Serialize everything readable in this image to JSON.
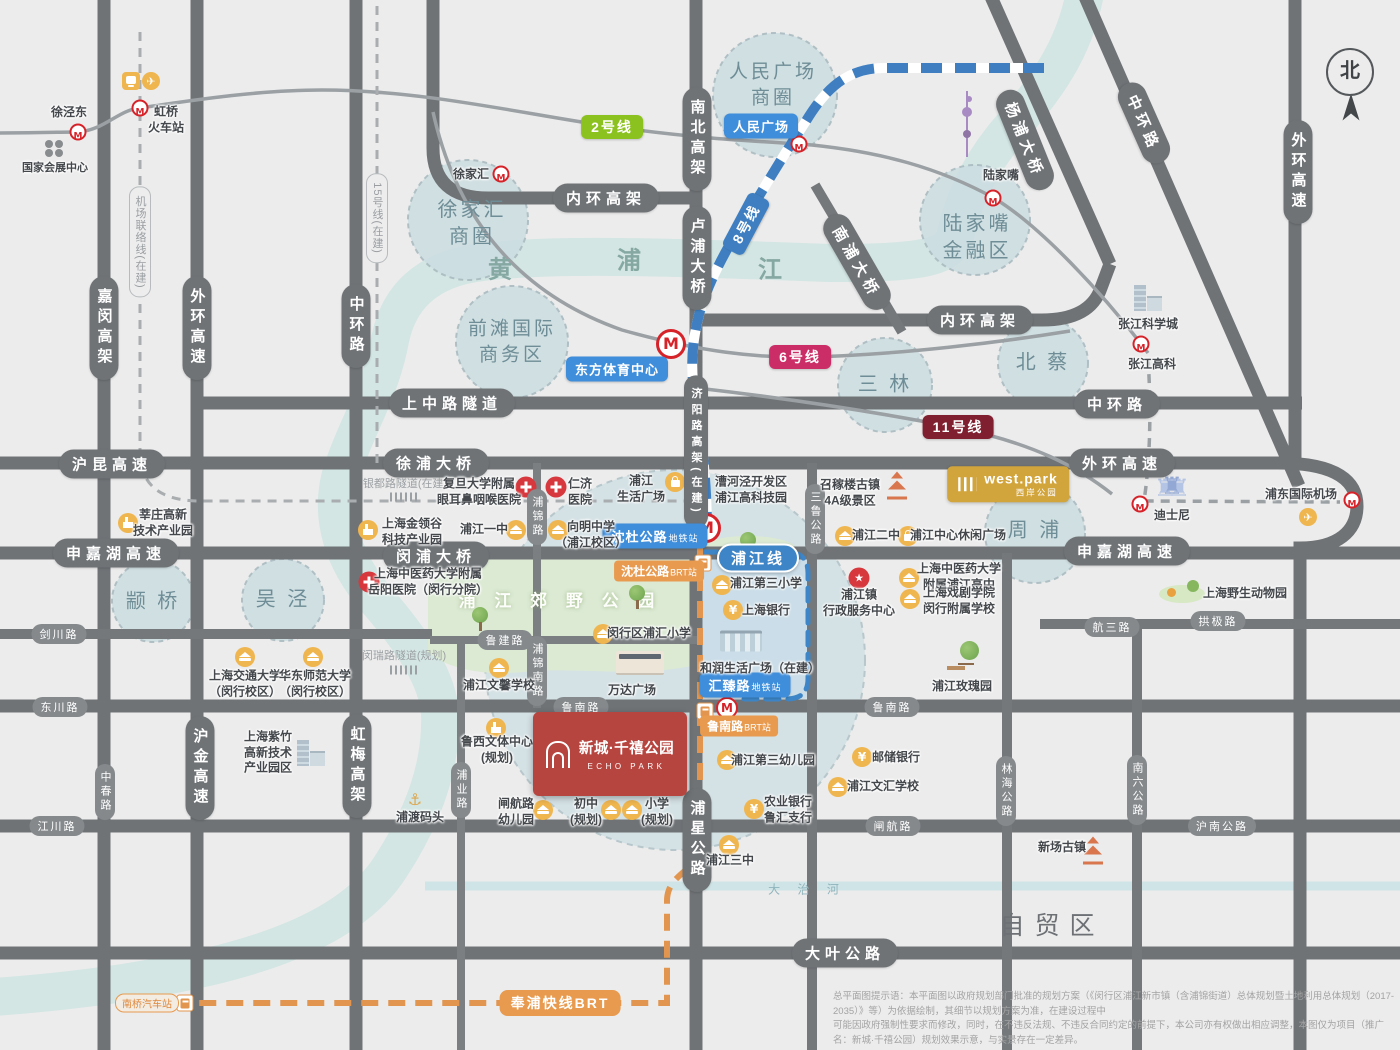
{
  "compass": {
    "label": "北"
  },
  "project": {
    "name_zh": "新城·千禧公园",
    "name_en": "ECHO PARK"
  },
  "west_park": {
    "name_en": "west.park",
    "name_zh": "西岸公园"
  },
  "disclaimer": {
    "line1": "总平面图提示语：本平面图以政府规划部门批准的规划方案（《闵行区浦江新市镇（含浦锦街道）总体规划暨土地利用总体规划（2017-2035）》等）为依据绘制，其细节以规划方案为准，在建设过程中",
    "line2": "可能因政府强制性要求而修改，同时，在不违反法规、不违反合同约定的前提下，本公司亦有权做出相应调整，本图仅为项目（推广名：新城·千禧公园）规划效果示意，与实景存在一定差异。"
  },
  "colors": {
    "road": "#6f7376",
    "river": "#d3e6e3",
    "district": "#cddee2",
    "metro_red": "#d6232a",
    "line2": "#8cc21f",
    "line6": "#cb2e67",
    "line8": "#3f7fc1",
    "line11": "#801f30",
    "brt_orange": "#e89a4f",
    "station_blue": "#3f8edb",
    "project_red": "#b7453f",
    "gold": "#d2a43c"
  },
  "labels": [
    {
      "c": "pill-v",
      "t": "嘉闵高架",
      "x": 104,
      "y": 328
    },
    {
      "c": "pill-v",
      "t": "外环高速",
      "x": 197,
      "y": 328
    },
    {
      "c": "pill-v",
      "t": "中环路",
      "x": 356,
      "y": 326
    },
    {
      "c": "pill-v",
      "t": "南北高架",
      "x": 697,
      "y": 139
    },
    {
      "c": "pill-v",
      "t": "卢浦大桥",
      "x": 697,
      "y": 258
    },
    {
      "c": "pill-v",
      "t": "济阳路高架(在建)",
      "x": 696,
      "y": 452,
      "fs": 11
    },
    {
      "c": "pill-v",
      "t": "外环高速",
      "x": 1298,
      "y": 172
    },
    {
      "c": "pill-v",
      "t": "浦星公路",
      "x": 697,
      "y": 840
    },
    {
      "c": "pill-v",
      "t": "沪金高速",
      "x": 200,
      "y": 768
    },
    {
      "c": "pill-v",
      "t": "虹梅高架",
      "x": 357,
      "y": 766
    },
    {
      "c": "pill",
      "t": "内环高架",
      "x": 606,
      "y": 198
    },
    {
      "c": "pill",
      "t": "内环高架",
      "x": 980,
      "y": 320
    },
    {
      "c": "pill",
      "t": "上中路隧道",
      "x": 452,
      "y": 403
    },
    {
      "c": "pill",
      "t": "中环路",
      "x": 1117,
      "y": 404
    },
    {
      "c": "pill",
      "t": "沪昆高速",
      "x": 112,
      "y": 464
    },
    {
      "c": "pill",
      "t": "徐浦大桥",
      "x": 436,
      "y": 463
    },
    {
      "c": "pill",
      "t": "外环高速",
      "x": 1122,
      "y": 463
    },
    {
      "c": "pill",
      "t": "申嘉湖高速",
      "x": 116,
      "y": 553
    },
    {
      "c": "pill",
      "t": "闵浦大桥",
      "x": 436,
      "y": 556
    },
    {
      "c": "pill",
      "t": "申嘉湖高速",
      "x": 1127,
      "y": 551
    },
    {
      "c": "pill",
      "t": "大叶公路",
      "x": 845,
      "y": 953
    },
    {
      "c": "pill",
      "t": "杨浦大桥",
      "x": 1025,
      "y": 140,
      "r": 68
    },
    {
      "c": "pill",
      "t": "中环路",
      "x": 1144,
      "y": 123,
      "r": 66
    },
    {
      "c": "pill",
      "t": "南浦大桥",
      "x": 857,
      "y": 262,
      "r": 60
    },
    {
      "c": "pill-sm-v",
      "t": "三鲁公路",
      "x": 815,
      "y": 519
    },
    {
      "c": "pill-sm-v",
      "t": "林海公路",
      "x": 1006,
      "y": 791
    },
    {
      "c": "pill-sm-v",
      "t": "南六公路",
      "x": 1137,
      "y": 790
    },
    {
      "c": "pill-sm-v",
      "t": "中春路",
      "x": 105,
      "y": 792
    },
    {
      "c": "pill-sm-v",
      "t": "浦锦路",
      "x": 537,
      "y": 517
    },
    {
      "c": "pill-sm-v",
      "t": "浦锦南路",
      "x": 537,
      "y": 671
    },
    {
      "c": "pill-sm-v",
      "t": "浦业路",
      "x": 461,
      "y": 790
    },
    {
      "c": "pill-sm",
      "t": "剑川路",
      "x": 59,
      "y": 634
    },
    {
      "c": "pill-sm",
      "t": "东川路",
      "x": 60,
      "y": 707
    },
    {
      "c": "pill-sm",
      "t": "江川路",
      "x": 57,
      "y": 826
    },
    {
      "c": "pill-sm",
      "t": "鲁建路",
      "x": 505,
      "y": 640
    },
    {
      "c": "pill-sm",
      "t": "鲁南路",
      "x": 581,
      "y": 707
    },
    {
      "c": "pill-sm",
      "t": "鲁南路",
      "x": 892,
      "y": 707
    },
    {
      "c": "pill-sm",
      "t": "闸航路",
      "x": 893,
      "y": 826
    },
    {
      "c": "pill-sm",
      "t": "沪南公路",
      "x": 1222,
      "y": 826
    },
    {
      "c": "pill-sm",
      "t": "航三路",
      "x": 1112,
      "y": 627
    },
    {
      "c": "pill-sm",
      "t": "拱极路",
      "x": 1218,
      "y": 621
    },
    {
      "c": "pill-dash-v",
      "t": "机场联络线(在建)",
      "x": 140,
      "y": 242
    },
    {
      "c": "pill-dash-v",
      "t": "15号线(在建)",
      "x": 377,
      "y": 218
    },
    {
      "c": "tuntext",
      "t": "银都路隧道(在建)",
      "x": 405,
      "y": 483
    },
    {
      "c": "tuntext",
      "t": "闵瑞路隧道(规划)",
      "x": 404,
      "y": 655
    },
    {
      "c": "lbl-line",
      "t": "2号线",
      "x": 612,
      "y": 127,
      "bg": "line2"
    },
    {
      "c": "lbl-line",
      "t": "6号线",
      "x": 800,
      "y": 357,
      "bg": "line6"
    },
    {
      "c": "lbl-line",
      "t": "11号线",
      "x": 958,
      "y": 427,
      "bg": "line11"
    },
    {
      "c": "lbl-line",
      "t": "8号线",
      "x": 746,
      "y": 224,
      "bg": "line8",
      "r": -62
    },
    {
      "c": "lbl-blue",
      "t": "人民广场",
      "x": 761,
      "y": 126
    },
    {
      "c": "lbl-blue",
      "t": "东方体育中心",
      "x": 617,
      "y": 369
    },
    {
      "c": "lbl-blue",
      "t": "沈杜公路",
      "suf": "地铁站",
      "x": 655,
      "y": 536
    },
    {
      "c": "lbl-blue",
      "t": "汇臻路",
      "suf": "地铁站",
      "x": 745,
      "y": 685
    },
    {
      "c": "lbl-pjline",
      "t": "浦江线",
      "x": 758,
      "y": 558
    },
    {
      "c": "lbl-org",
      "t": "沈杜公路",
      "suf": "BRT站",
      "x": 659,
      "y": 571
    },
    {
      "c": "lbl-org",
      "t": "鲁南路",
      "suf": "BRT站",
      "x": 739,
      "y": 726
    },
    {
      "c": "lbl-org-line",
      "t": "奉浦快线BRT",
      "x": 560,
      "y": 1003
    },
    {
      "c": "lbl-org-o",
      "t": "南桥汽车站",
      "x": 147,
      "y": 1003
    },
    {
      "c": "ctext",
      "t": [
        "人民广场",
        "商圈"
      ],
      "x": 773,
      "y": 85,
      "fs": 19
    },
    {
      "c": "ctext",
      "t": [
        "徐家汇",
        "商圈"
      ],
      "x": 472,
      "y": 224
    },
    {
      "c": "ctext",
      "t": [
        "前滩国际",
        "商务区"
      ],
      "x": 512,
      "y": 342,
      "fs": 19
    },
    {
      "c": "ctext",
      "t": [
        "陆家嘴",
        "金融区"
      ],
      "x": 977,
      "y": 238
    },
    {
      "c": "ctext",
      "t": "三 林",
      "x": 885,
      "y": 385
    },
    {
      "c": "ctext",
      "t": "北 蔡",
      "x": 1043,
      "y": 363
    },
    {
      "c": "ctext",
      "t": "周 浦",
      "x": 1035,
      "y": 531
    },
    {
      "c": "ctext",
      "t": "颛 桥",
      "x": 153,
      "y": 602
    },
    {
      "c": "ctext",
      "t": "吴 泾",
      "x": 283,
      "y": 600
    },
    {
      "c": "rtext",
      "t": "黄",
      "x": 500,
      "y": 267
    },
    {
      "c": "rtext",
      "t": "浦",
      "x": 629,
      "y": 258
    },
    {
      "c": "rtext",
      "t": "江",
      "x": 770,
      "y": 267
    },
    {
      "c": "atext",
      "t": "自贸区",
      "x": 1052,
      "y": 924
    },
    {
      "c": "dhtext",
      "t": "大 治 河",
      "x": 807,
      "y": 889
    },
    {
      "c": "ptext",
      "t": "浦 江 郊 野 公 园",
      "x": 560,
      "y": 599
    },
    {
      "c": "poi",
      "t": "徐泾东",
      "x": 69,
      "y": 113
    },
    {
      "c": "poi",
      "t": [
        "虹桥",
        "火车站"
      ],
      "x": 166,
      "y": 120
    },
    {
      "c": "poi",
      "t": "国家会展中心",
      "x": 55,
      "y": 168,
      "fs": 11
    },
    {
      "c": "poi",
      "t": "徐家汇",
      "x": 471,
      "y": 175
    },
    {
      "c": "poi",
      "t": "陆家嘴",
      "x": 1001,
      "y": 176
    },
    {
      "c": "poi",
      "t": "张江科学城",
      "x": 1148,
      "y": 325
    },
    {
      "c": "poi",
      "t": "张江高科",
      "x": 1152,
      "y": 365
    },
    {
      "c": "poi",
      "t": [
        "莘庄高新",
        "技术产业园"
      ],
      "x": 163,
      "y": 523
    },
    {
      "c": "poi",
      "t": [
        "上海金领谷",
        "科技产业园"
      ],
      "x": 412,
      "y": 532
    },
    {
      "c": "poi",
      "t": [
        "复旦大学附属",
        "眼耳鼻咽喉医院"
      ],
      "x": 479,
      "y": 492
    },
    {
      "c": "poi",
      "t": [
        "仁济",
        "医院"
      ],
      "x": 580,
      "y": 492
    },
    {
      "c": "poi",
      "t": [
        "浦江",
        "生活广场"
      ],
      "x": 641,
      "y": 489
    },
    {
      "c": "poi",
      "t": [
        "漕河泾开发区",
        "浦江高科技园"
      ],
      "x": 751,
      "y": 490
    },
    {
      "c": "poi",
      "t": [
        "召稼楼古镇",
        "4A级景区"
      ],
      "x": 850,
      "y": 493
    },
    {
      "c": "poi",
      "t": "迪士尼",
      "x": 1172,
      "y": 516
    },
    {
      "c": "poi",
      "t": "浦东国际机场",
      "x": 1301,
      "y": 495
    },
    {
      "c": "poi",
      "t": "浦江一中",
      "x": 484,
      "y": 530
    },
    {
      "c": "poi",
      "t": [
        "向明中学",
        "（浦江校区）"
      ],
      "x": 591,
      "y": 535
    },
    {
      "c": "poi",
      "t": [
        "上海中医药大学附属",
        "岳阳医院（闵行分院）"
      ],
      "x": 428,
      "y": 582
    },
    {
      "c": "poi",
      "t": [
        "上海交通大学",
        "（闵行校区）"
      ],
      "x": 245,
      "y": 684
    },
    {
      "c": "poi",
      "t": [
        "华东师范大学",
        "（闵行校区）"
      ],
      "x": 315,
      "y": 684
    },
    {
      "c": "poi",
      "t": "浦江二中",
      "x": 876,
      "y": 536
    },
    {
      "c": "poi",
      "t": "浦江中心休闲广场",
      "x": 958,
      "y": 536
    },
    {
      "c": "poi",
      "t": [
        "浦江镇",
        "行政服务中心"
      ],
      "x": 859,
      "y": 603
    },
    {
      "c": "poi",
      "t": [
        "上海中医药大学",
        "附属浦江高中"
      ],
      "x": 959,
      "y": 577
    },
    {
      "c": "poi",
      "t": [
        "上海戏剧学院",
        "闵行附属学校"
      ],
      "x": 959,
      "y": 601
    },
    {
      "c": "poi",
      "t": "上海野生动物园",
      "x": 1245,
      "y": 594
    },
    {
      "c": "poi",
      "t": "浦江第三小学",
      "x": 766,
      "y": 584
    },
    {
      "c": "poi",
      "t": "上海银行",
      "x": 766,
      "y": 611
    },
    {
      "c": "poi",
      "t": "和润生活广场（在建）",
      "x": 760,
      "y": 669
    },
    {
      "c": "poi",
      "t": "闵行区浦汇小学",
      "x": 649,
      "y": 634
    },
    {
      "c": "poi",
      "t": "浦江文馨学校",
      "x": 499,
      "y": 686
    },
    {
      "c": "poi",
      "t": "万达广场",
      "x": 632,
      "y": 691
    },
    {
      "c": "poi",
      "t": [
        "鲁西文体中心",
        "(规划)"
      ],
      "x": 497,
      "y": 750
    },
    {
      "c": "poi",
      "t": [
        "闸航路",
        "幼儿园"
      ],
      "x": 516,
      "y": 812
    },
    {
      "c": "poi",
      "t": [
        "初中",
        "(规划)"
      ],
      "x": 586,
      "y": 812
    },
    {
      "c": "poi",
      "t": [
        "小学",
        "(规划)"
      ],
      "x": 657,
      "y": 812
    },
    {
      "c": "poi",
      "t": "浦江第三幼儿园",
      "x": 773,
      "y": 761
    },
    {
      "c": "poi",
      "t": [
        "农业银行",
        "鲁汇支行"
      ],
      "x": 788,
      "y": 810
    },
    {
      "c": "poi",
      "t": "邮储银行",
      "x": 896,
      "y": 758
    },
    {
      "c": "poi",
      "t": "浦江文汇学校",
      "x": 883,
      "y": 787
    },
    {
      "c": "poi",
      "t": "浦江玫瑰园",
      "x": 962,
      "y": 687
    },
    {
      "c": "poi",
      "t": [
        "上海紫竹",
        "高新技术",
        "产业园区"
      ],
      "x": 268,
      "y": 753
    },
    {
      "c": "poi",
      "t": "浦渡码头",
      "x": 420,
      "y": 818
    },
    {
      "c": "poi",
      "t": "浦江三中",
      "x": 730,
      "y": 861
    },
    {
      "c": "poi",
      "t": "新场古镇",
      "x": 1062,
      "y": 848
    }
  ],
  "icons": [
    {
      "k": "metro",
      "x": 78,
      "y": 132
    },
    {
      "k": "metro",
      "x": 140,
      "y": 108
    },
    {
      "k": "metro",
      "x": 799,
      "y": 144
    },
    {
      "k": "metro",
      "x": 501,
      "y": 174
    },
    {
      "k": "metro",
      "x": 993,
      "y": 198
    },
    {
      "k": "metro",
      "x": 1141,
      "y": 344
    },
    {
      "k": "metro",
      "x": 1140,
      "y": 504
    },
    {
      "k": "metro",
      "x": 1352,
      "y": 500
    },
    {
      "k": "metro-lg",
      "x": 671,
      "y": 344
    },
    {
      "k": "metro-lg",
      "x": 706,
      "y": 528
    },
    {
      "k": "metro-md",
      "x": 727,
      "y": 708
    },
    {
      "k": "school",
      "x": 516,
      "y": 530
    },
    {
      "k": "school",
      "x": 558,
      "y": 530
    },
    {
      "k": "school",
      "x": 845,
      "y": 536
    },
    {
      "k": "school",
      "x": 909,
      "y": 578
    },
    {
      "k": "school",
      "x": 910,
      "y": 599
    },
    {
      "k": "school",
      "x": 722,
      "y": 585
    },
    {
      "k": "school",
      "x": 603,
      "y": 634
    },
    {
      "k": "school",
      "x": 499,
      "y": 668
    },
    {
      "k": "school",
      "x": 543,
      "y": 810
    },
    {
      "k": "school",
      "x": 611,
      "y": 810
    },
    {
      "k": "school",
      "x": 632,
      "y": 810
    },
    {
      "k": "school",
      "x": 727,
      "y": 760
    },
    {
      "k": "school",
      "x": 838,
      "y": 787
    },
    {
      "k": "school",
      "x": 729,
      "y": 845
    },
    {
      "k": "school",
      "x": 245,
      "y": 657
    },
    {
      "k": "school",
      "x": 313,
      "y": 657
    },
    {
      "k": "bank",
      "x": 733,
      "y": 610
    },
    {
      "k": "bank",
      "x": 754,
      "y": 809
    },
    {
      "k": "bank",
      "x": 862,
      "y": 757
    },
    {
      "k": "bag",
      "x": 675,
      "y": 482
    },
    {
      "k": "bag",
      "x": 908,
      "y": 536
    },
    {
      "k": "cross",
      "x": 526,
      "y": 487
    },
    {
      "k": "cross",
      "x": 556,
      "y": 487
    },
    {
      "k": "cross",
      "x": 369,
      "y": 582
    },
    {
      "k": "star",
      "x": 859,
      "y": 578
    },
    {
      "k": "factory",
      "x": 128,
      "y": 523
    },
    {
      "k": "factory",
      "x": 368,
      "y": 530
    },
    {
      "k": "factory",
      "x": 496,
      "y": 728
    },
    {
      "k": "bus",
      "x": 703,
      "y": 563
    },
    {
      "k": "bus",
      "x": 705,
      "y": 711
    },
    {
      "k": "bus",
      "x": 185,
      "y": 1003
    },
    {
      "k": "train",
      "x": 131,
      "y": 81
    },
    {
      "k": "plane",
      "x": 151,
      "y": 81
    },
    {
      "k": "plane",
      "x": 1308,
      "y": 517
    },
    {
      "k": "clover",
      "x": 54,
      "y": 150
    },
    {
      "k": "tree",
      "x": 637,
      "y": 598
    },
    {
      "k": "tree",
      "x": 480,
      "y": 620
    },
    {
      "k": "tree",
      "x": 748,
      "y": 545
    },
    {
      "k": "pearl",
      "x": 967,
      "y": 124
    },
    {
      "k": "pagoda",
      "x": 897,
      "y": 485
    },
    {
      "k": "pagoda",
      "x": 1093,
      "y": 850
    },
    {
      "k": "castle",
      "x": 1172,
      "y": 486
    },
    {
      "k": "build2",
      "x": 1147,
      "y": 297
    },
    {
      "k": "build2",
      "x": 310,
      "y": 752
    },
    {
      "k": "mallw",
      "x": 640,
      "y": 663
    },
    {
      "k": "mallh",
      "x": 741,
      "y": 641
    },
    {
      "k": "anchor",
      "x": 415,
      "y": 800
    },
    {
      "k": "parkb",
      "x": 963,
      "y": 656
    },
    {
      "k": "wild",
      "x": 1182,
      "y": 594
    },
    {
      "k": "hatch",
      "x": 404,
      "y": 497
    },
    {
      "k": "hatch",
      "x": 404,
      "y": 670
    }
  ]
}
